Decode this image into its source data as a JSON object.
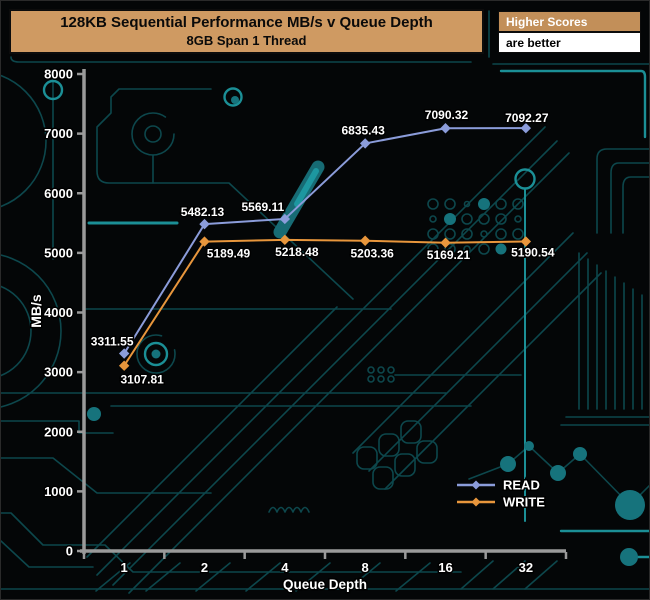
{
  "header": {
    "title": "128KB Sequential Performance MB/s v Queue Depth",
    "subtitle": "8GB Span 1 Thread"
  },
  "badge": {
    "top": "Higher Scores",
    "bottom": "are better"
  },
  "chart_data": {
    "type": "line",
    "title": "128KB Sequential Performance MB/s v Queue Depth",
    "subtitle": "8GB Span 1 Thread",
    "categories": [
      "1",
      "2",
      "4",
      "8",
      "16",
      "32"
    ],
    "series": [
      {
        "name": "READ",
        "color": "#8b9cda",
        "values": [
          3311.55,
          5482.13,
          5569.11,
          6835.43,
          7090.32,
          7092.27
        ],
        "label_side": "above",
        "label_dx": [
          -12,
          -2,
          -22,
          -2,
          1,
          1
        ],
        "label_dy": [
          -8,
          -8,
          -8,
          -9,
          -9,
          -6
        ]
      },
      {
        "name": "WRITE",
        "color": "#e8963c",
        "values": [
          3107.81,
          5189.49,
          5218.48,
          5203.36,
          5169.21,
          5190.54
        ],
        "label_side": "below",
        "label_dx": [
          18,
          24,
          12,
          7,
          3,
          7
        ],
        "label_dy": [
          18,
          16,
          16,
          17,
          16,
          15
        ]
      }
    ],
    "xlabel": "Queue Depth",
    "ylabel": "MB/s",
    "ylim": [
      0,
      8000
    ],
    "ytick_step": 1000,
    "grid": false,
    "marker": "diamond",
    "value_labels": true,
    "legend_position": "lower-right",
    "colors": {
      "axis": "#9a9a9a",
      "text": "#ffffff",
      "background": "#040607"
    }
  }
}
